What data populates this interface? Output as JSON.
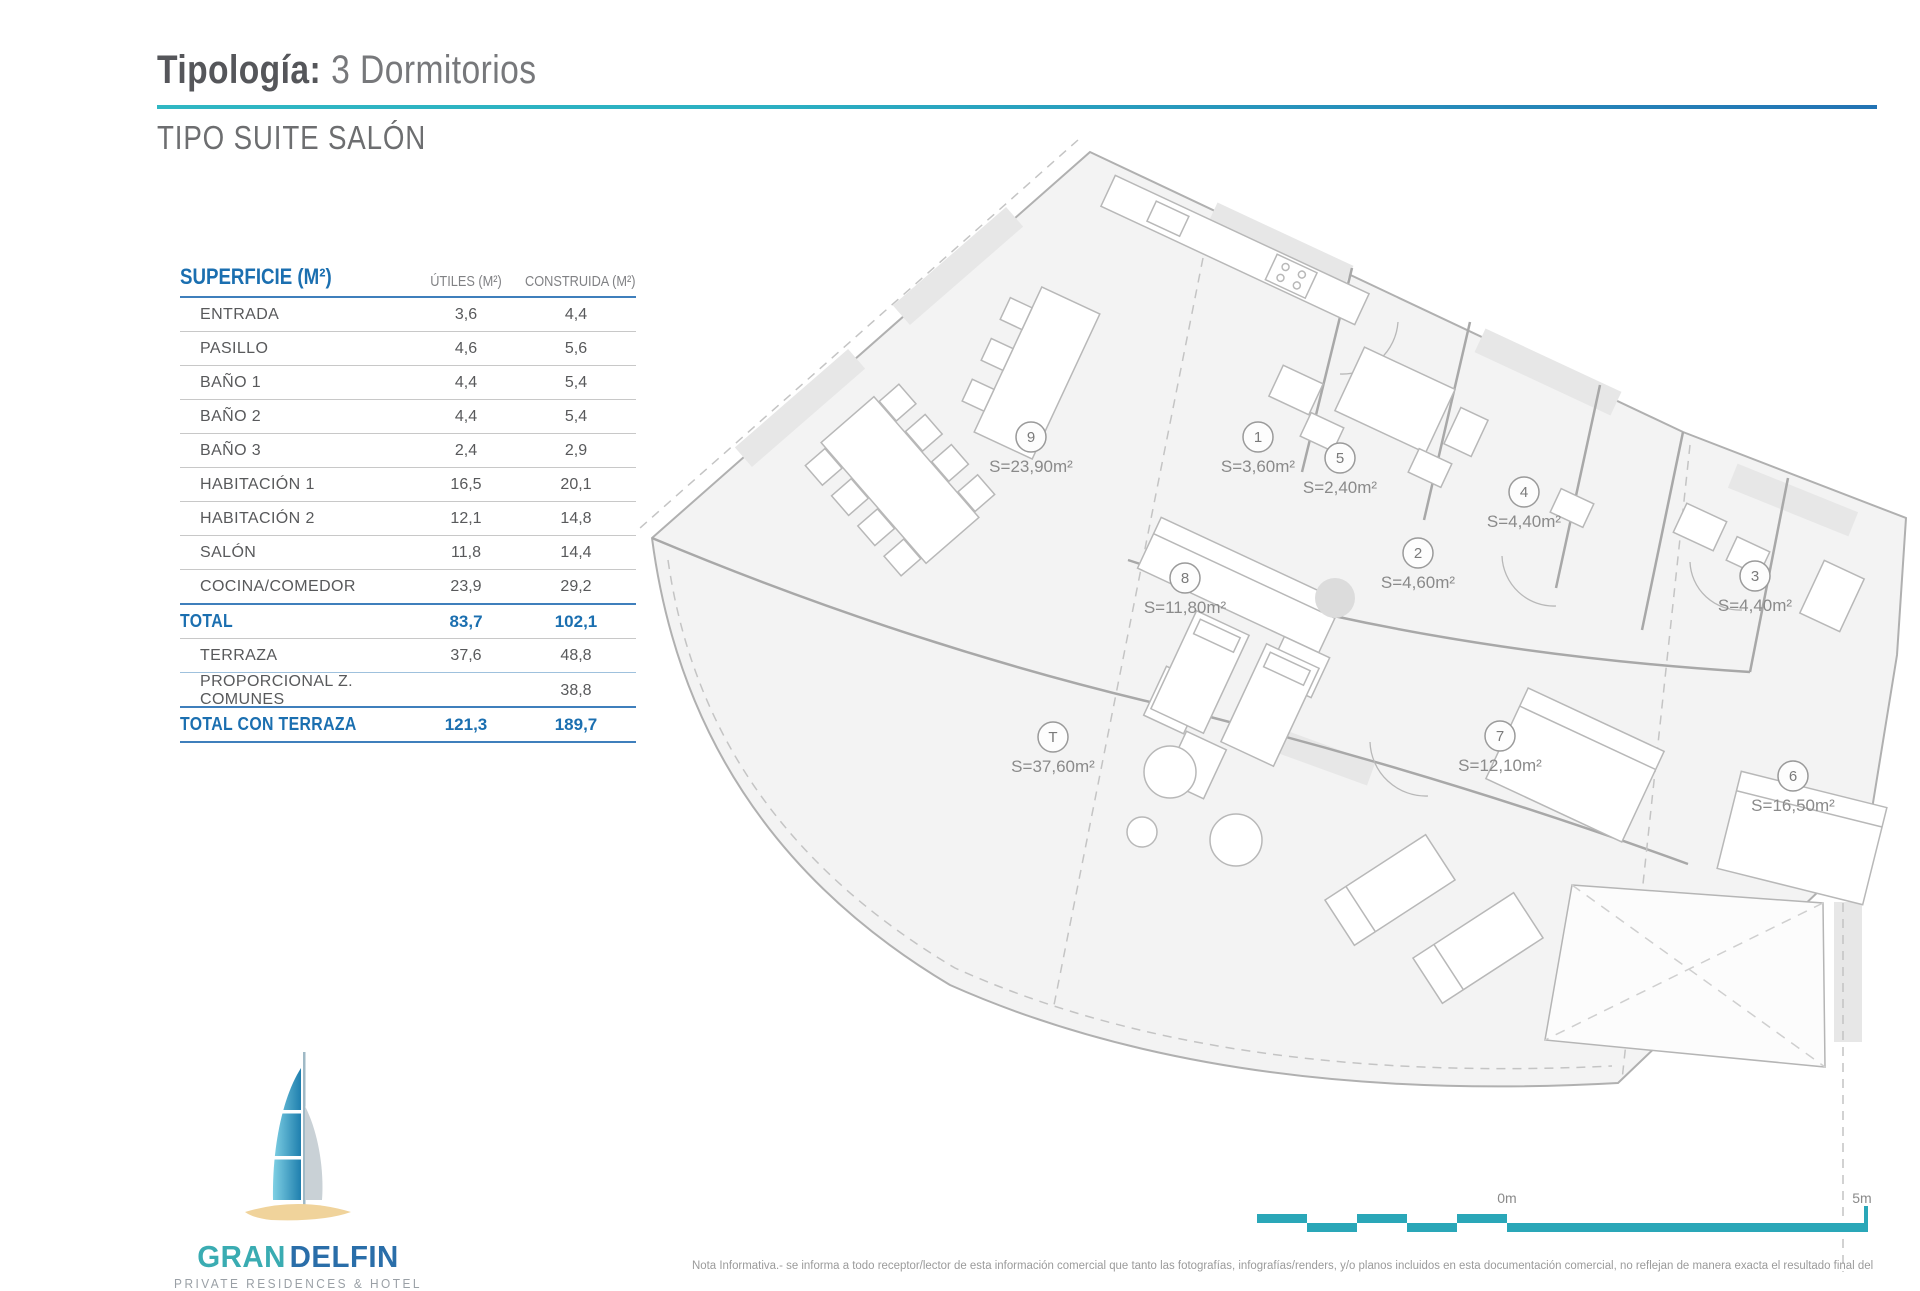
{
  "header": {
    "title_label": "Tipología:",
    "title_value": "3 Dormitorios",
    "subtitle": "TIPO SUITE SALÓN"
  },
  "table": {
    "columns": {
      "c1": "SUPERFICIE (M²)",
      "c2": "ÚTILES (M²)",
      "c3": "CONSTRUIDA (M²)"
    },
    "rows": [
      {
        "label": "ENTRADA",
        "utiles": "3,6",
        "construida": "4,4"
      },
      {
        "label": "PASILLO",
        "utiles": "4,6",
        "construida": "5,6"
      },
      {
        "label": "BAÑO 1",
        "utiles": "4,4",
        "construida": "5,4"
      },
      {
        "label": "BAÑO 2",
        "utiles": "4,4",
        "construida": "5,4"
      },
      {
        "label": "BAÑO 3",
        "utiles": "2,4",
        "construida": "2,9"
      },
      {
        "label": "HABITACIÓN 1",
        "utiles": "16,5",
        "construida": "20,1"
      },
      {
        "label": "HABITACIÓN 2",
        "utiles": "12,1",
        "construida": "14,8"
      },
      {
        "label": "SALÓN",
        "utiles": "11,8",
        "construida": "14,4"
      },
      {
        "label": "COCINA/COMEDOR",
        "utiles": "23,9",
        "construida": "29,2"
      }
    ],
    "total": {
      "label": "TOTAL",
      "utiles": "83,7",
      "construida": "102,1"
    },
    "terraza": {
      "label": "TERRAZA",
      "utiles": "37,6",
      "construida": "48,8"
    },
    "comunes": {
      "label": "PROPORCIONAL Z. COMUNES",
      "utiles": "",
      "construida": "38,8"
    },
    "grandtotal": {
      "label": "TOTAL CON TERRAZA",
      "utiles": "121,3",
      "construida": "189,7"
    }
  },
  "plan": {
    "rooms": [
      {
        "num": "9",
        "area": "S=23,90m²"
      },
      {
        "num": "1",
        "area": "S=3,60m²"
      },
      {
        "num": "5",
        "area": "S=2,40m²"
      },
      {
        "num": "4",
        "area": "S=4,40m²"
      },
      {
        "num": "2",
        "area": "S=4,60m²"
      },
      {
        "num": "8",
        "area": "S=11,80m²"
      },
      {
        "num": "3",
        "area": "S=4,40m²"
      },
      {
        "num": "T",
        "area": "S=37,60m²"
      },
      {
        "num": "7",
        "area": "S=12,10m²"
      },
      {
        "num": "6",
        "area": "S=16,50m²"
      }
    ]
  },
  "scalebar": {
    "zero": "0m",
    "five": "5m"
  },
  "logo": {
    "gran": "GRAN",
    "delfin": "DELFIN",
    "subtitle": "PRIVATE RESIDENCES & HOTEL"
  },
  "footer": {
    "note": "Nota Informativa.- se informa a todo receptor/lector de esta información comercial que tanto las fotografías, infografías/renders, y/o planos incluidos en esta documentación comercial, no reflejan de manera exacta el resultado final del"
  },
  "colors": {
    "accent_teal": "#2fb7c3",
    "accent_blue": "#2273b4",
    "table_blue": "#1b6fb0",
    "text_dark": "#55565a",
    "text_gray": "#6d6e70",
    "plan_line": "#b0b0b0",
    "scalebar_teal": "#2aa7b8",
    "logo_sand": "#f0d39b"
  }
}
